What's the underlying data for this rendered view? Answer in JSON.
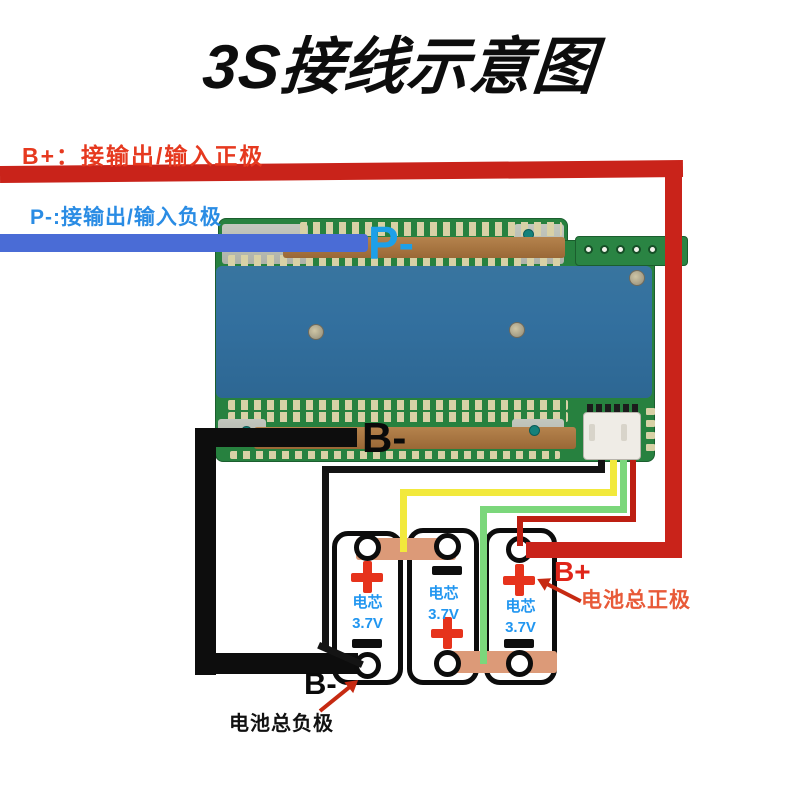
{
  "title": "3S接线示意图",
  "top_labels": {
    "b_plus": "B+：接输出/输入正极",
    "p_minus": "P-:接输出/输入负极"
  },
  "board": {
    "p_minus_pad": "P-",
    "b_minus_pad": "B-"
  },
  "cells": [
    {
      "name": "电芯",
      "voltage": "3.7V",
      "top_polarity": "+",
      "bottom_polarity": "-"
    },
    {
      "name": "电芯",
      "voltage": "3.7V",
      "top_polarity": "-",
      "bottom_polarity": "+"
    },
    {
      "name": "电芯",
      "voltage": "3.7V",
      "top_polarity": "+",
      "bottom_polarity": "-"
    }
  ],
  "annotations": {
    "b_plus": "B+",
    "battery_positive": "电池总正极",
    "b_minus": "B-",
    "battery_negative": "电池总负极"
  },
  "colors": {
    "b_plus_wire": "#c9231a",
    "p_minus_wire": "#4a6cd6",
    "b_minus_wire": "#0d0d0d",
    "balance_black": "#141414",
    "balance_yellow": "#f2e93c",
    "balance_green": "#7bd77b",
    "balance_red": "#bd1f12",
    "nickel_strip": "#dc9a78",
    "pcb_green": "#27813f",
    "heatsink_blue": "#33709f",
    "copper_bus": "#a9743f",
    "cell_label_blue": "#2196f0",
    "plus_symbol_red": "#e6331c"
  }
}
